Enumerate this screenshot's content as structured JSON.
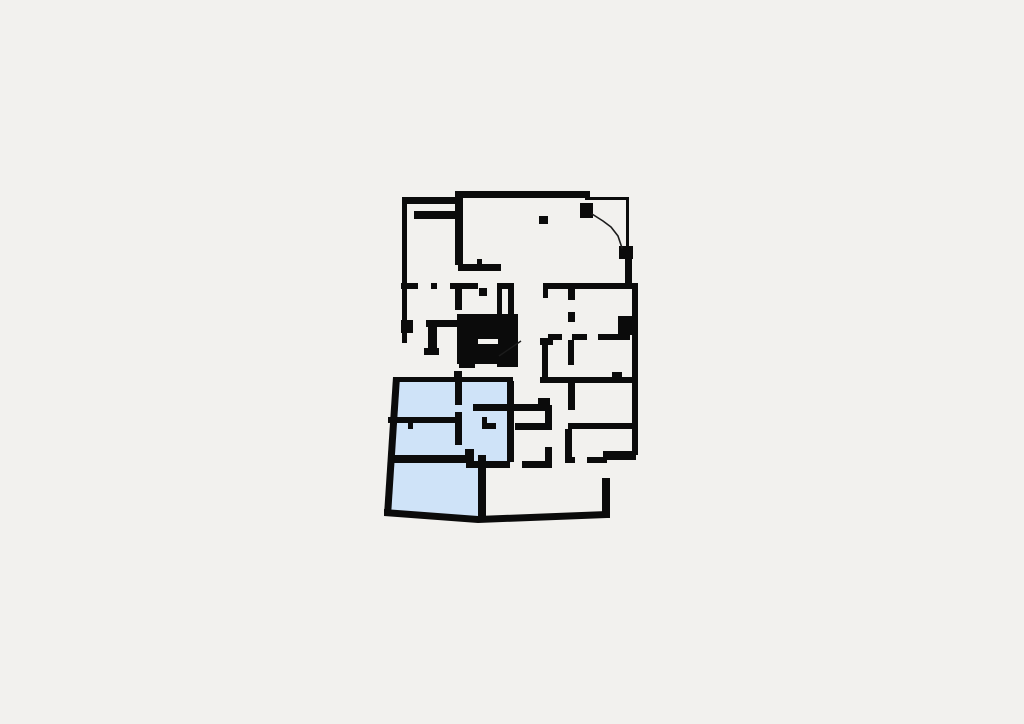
{
  "meta": {
    "description": "Architectural floor plan with highlighted apartment unit",
    "canvas": {
      "width": 1024,
      "height": 724
    }
  },
  "palette": {
    "background": "#f2f1ee",
    "wall": "#0b0b0b",
    "highlight": "#cfe3f8",
    "thin_line": "#1c1c1c",
    "slot": "#f4f3f0"
  },
  "floor_plan": {
    "highlight_region": {
      "name": "highlighted-apartment-region",
      "points": "394,379 511,381 511,463 480,463 480,518 386,514"
    },
    "walls": [
      [
        402,
        197,
        60,
        7
      ],
      [
        455,
        191,
        135,
        7
      ],
      [
        585,
        197,
        44,
        3
      ],
      [
        626,
        199,
        3,
        50
      ],
      [
        580,
        203,
        13,
        15
      ],
      [
        619,
        246,
        14,
        13
      ],
      [
        625,
        257,
        7,
        31
      ],
      [
        543,
        283,
        95,
        6
      ],
      [
        632,
        288,
        6,
        167
      ],
      [
        603,
        451,
        33,
        9
      ],
      [
        602,
        478,
        8,
        40
      ],
      [
        402,
        197,
        5,
        146
      ],
      [
        401,
        325,
        12,
        8
      ],
      [
        428,
        327,
        9,
        28
      ],
      [
        424,
        348,
        15,
        7
      ],
      [
        401,
        320,
        12,
        7
      ],
      [
        426,
        320,
        32,
        7
      ],
      [
        455,
        198,
        8,
        67
      ],
      [
        458,
        264,
        43,
        7
      ],
      [
        477,
        259,
        5,
        5
      ],
      [
        414,
        211,
        44,
        8
      ],
      [
        539,
        216,
        9,
        8
      ],
      [
        401,
        283,
        17,
        6
      ],
      [
        431,
        283,
        6,
        6
      ],
      [
        450,
        283,
        28,
        6
      ],
      [
        479,
        288,
        8,
        8
      ],
      [
        497,
        283,
        11,
        6
      ],
      [
        497,
        288,
        5,
        27
      ],
      [
        508,
        283,
        6,
        32
      ],
      [
        455,
        288,
        7,
        22
      ],
      [
        543,
        283,
        5,
        15
      ],
      [
        568,
        288,
        7,
        12
      ],
      [
        568,
        312,
        7,
        10
      ],
      [
        618,
        316,
        14,
        19
      ],
      [
        548,
        334,
        14,
        6
      ],
      [
        572,
        334,
        15,
        6
      ],
      [
        598,
        334,
        32,
        6
      ],
      [
        542,
        338,
        6,
        40
      ],
      [
        540,
        338,
        13,
        7
      ],
      [
        568,
        340,
        6,
        25
      ],
      [
        540,
        377,
        93,
        6
      ],
      [
        612,
        372,
        10,
        5
      ],
      [
        568,
        383,
        7,
        27
      ],
      [
        568,
        423,
        65,
        6
      ],
      [
        565,
        429,
        7,
        29
      ],
      [
        565,
        457,
        10,
        6
      ],
      [
        587,
        457,
        20,
        6
      ],
      [
        473,
        404,
        77,
        7
      ],
      [
        538,
        398,
        12,
        7
      ],
      [
        507,
        381,
        7,
        81
      ],
      [
        515,
        423,
        37,
        7
      ],
      [
        545,
        405,
        7,
        25
      ],
      [
        545,
        447,
        7,
        14
      ],
      [
        466,
        461,
        44,
        7
      ],
      [
        522,
        461,
        30,
        7
      ],
      [
        482,
        417,
        5,
        7
      ],
      [
        482,
        423,
        14,
        6
      ],
      [
        393,
        377,
        120,
        5
      ],
      [
        454,
        371,
        8,
        7
      ],
      [
        455,
        382,
        7,
        23
      ],
      [
        455,
        412,
        7,
        33
      ],
      [
        388,
        417,
        67,
        6
      ],
      [
        408,
        423,
        5,
        6
      ],
      [
        388,
        455,
        80,
        8
      ],
      [
        465,
        449,
        9,
        14
      ],
      [
        478,
        455,
        8,
        63
      ]
    ],
    "wall_polygons": [
      {
        "name": "outer-wall-left-slanted",
        "points": "393,377 400,377 391,516 384,515"
      },
      {
        "name": "outer-wall-bottom",
        "points": "384,509 478,516 607,511 607,518 478,523 384,516"
      }
    ],
    "stair_core": {
      "name": "stair-core",
      "rect": [
        457,
        314,
        61,
        50
      ],
      "feet": [
        [
          459,
          362,
          16,
          6
        ],
        [
          497,
          362,
          21,
          5
        ]
      ],
      "slot": [
        478,
        339,
        20,
        5
      ],
      "diagonal": [
        499,
        356,
        521,
        341
      ]
    },
    "arc": {
      "name": "curved-wall-line",
      "points": "592,214 603,221 611,227 618,236 622,248"
    }
  }
}
